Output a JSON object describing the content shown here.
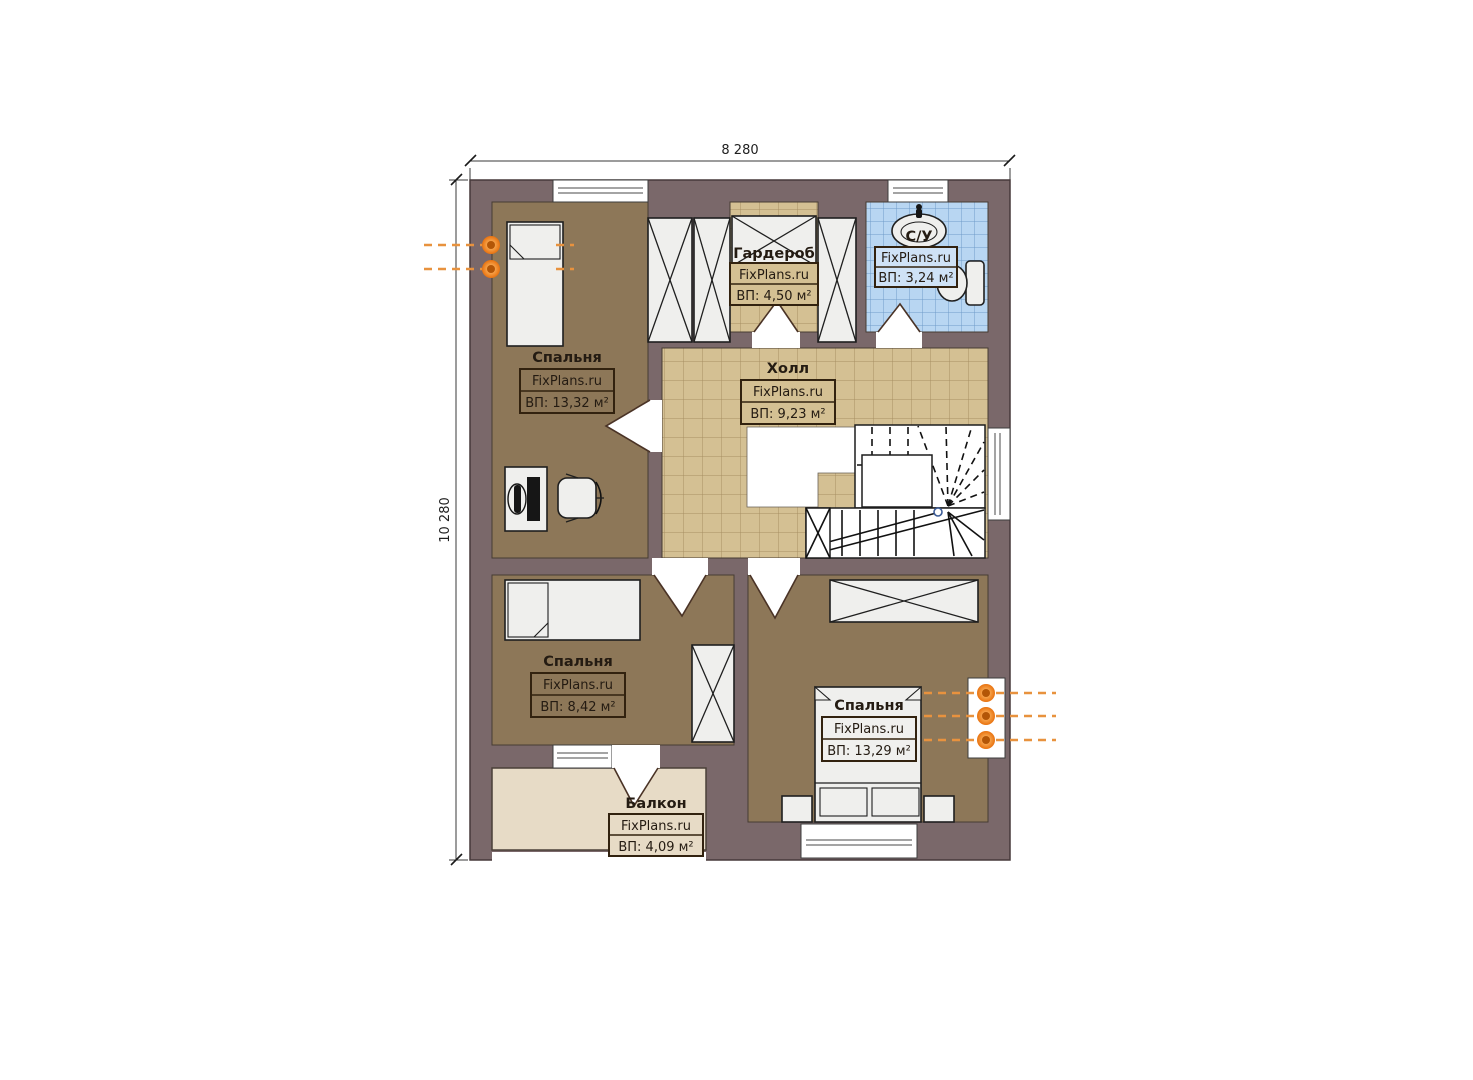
{
  "watermark": "FixPlans.ru",
  "dimensions": {
    "width": "8 280",
    "height": "10 280"
  },
  "rooms": {
    "bedroom_top_left": {
      "name": "Спальня",
      "area": "ВП: 13,32 м²"
    },
    "wardrobe": {
      "name": "Гардероб",
      "area": "ВП: 4,50 м²"
    },
    "bathroom": {
      "name": "С/У",
      "area": "ВП: 3,24 м²"
    },
    "hall": {
      "name": "Холл",
      "area": "ВП: 9,23 м²"
    },
    "bedroom_bottom_left": {
      "name": "Спальня",
      "area": "ВП: 8,42 м²"
    },
    "bedroom_bottom_right": {
      "name": "Спальня",
      "area": "ВП: 13,29 м²"
    },
    "balcony": {
      "name": "Балкон",
      "area": "ВП: 4,09 м²"
    }
  },
  "colors": {
    "wall": "#7a686a",
    "bedroom_floor": "#8d7758",
    "hall_floor": "#d4c093",
    "bathroom_floor": "#b8d6f2",
    "balcony_floor": "#e7dbc6",
    "radiator": "#e8923e"
  }
}
